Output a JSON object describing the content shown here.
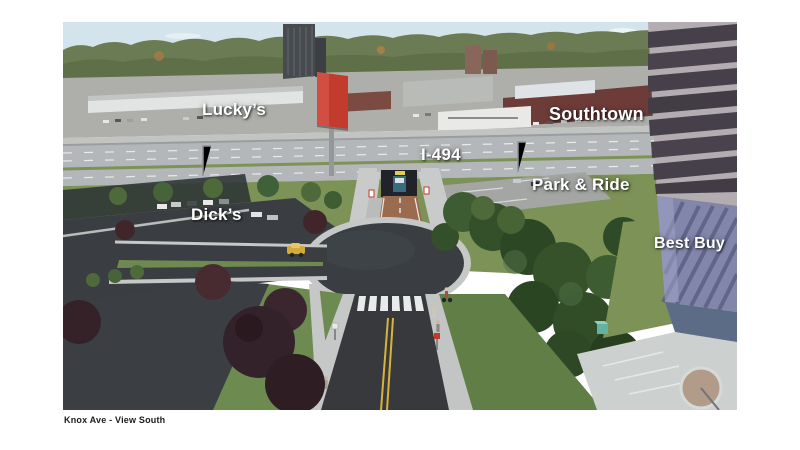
{
  "slide": {
    "caption": "Knox Ave - View South"
  },
  "annotations": {
    "luckys": "Lucky’s",
    "southtown": "Southtown",
    "highway": "I-494",
    "park_and_ride": "Park & Ride",
    "dicks": "Dick’s",
    "best_buy": "Best Buy"
  },
  "palette": {
    "sky": "#d3e4ec",
    "treeline": "#6b7b53",
    "grass": "#7d9257",
    "dark_foliage": "#33502a",
    "ornamental_tree": "#3a2428",
    "asphalt": "#3a3e42",
    "highway_pavement": "#b4b7b9",
    "sidewalk": "#c6c8c7",
    "trail_surface": "#9b6b50",
    "billboard_red": "#c23b2d",
    "best_buy_upper": "#46404a",
    "best_buy_lower": "#8286aa",
    "label_text": "#ffffff",
    "caption_text": "#1c1c1c"
  }
}
